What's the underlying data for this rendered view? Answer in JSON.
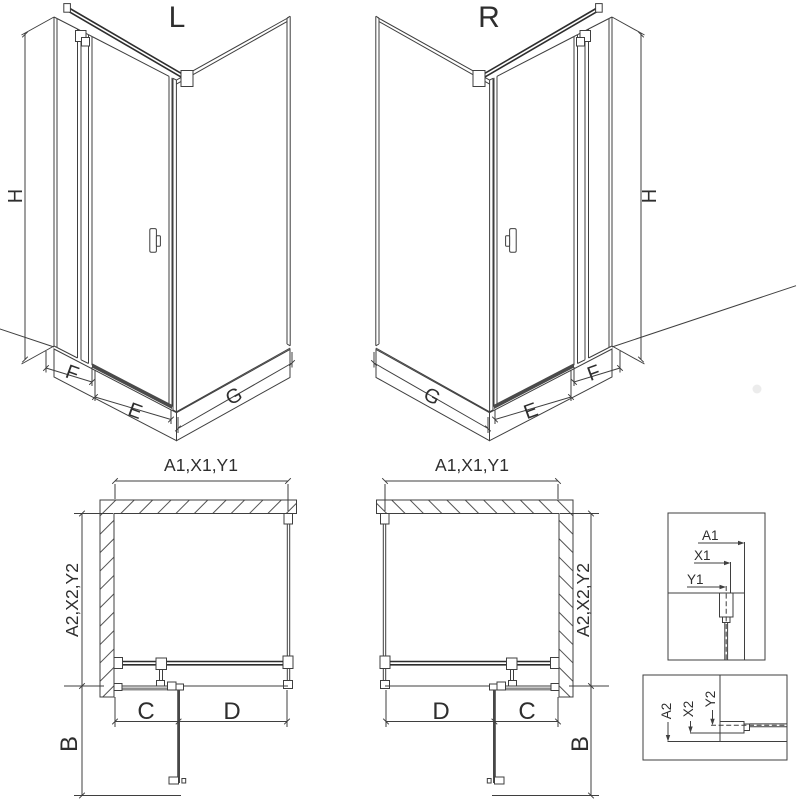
{
  "diagram": {
    "variant_left": {
      "title": "L",
      "dim_height": "H",
      "dim_fixed_panel": "F",
      "dim_door": "E",
      "dim_side_panel": "G"
    },
    "variant_right": {
      "title": "R",
      "dim_height": "H",
      "dim_fixed_panel": "F",
      "dim_door": "E",
      "dim_side_panel": "G"
    },
    "plan_left": {
      "dim_width": "A1,X1,Y1",
      "dim_depth": "A2,X2,Y2",
      "dim_fixed": "C",
      "dim_door": "D",
      "dim_swing": "B"
    },
    "plan_right": {
      "dim_width": "A1,X1,Y1",
      "dim_depth": "A2,X2,Y2",
      "dim_fixed": "C",
      "dim_door": "D",
      "dim_swing": "B"
    },
    "detail_wall_vertical": {
      "dim_outer": "A1",
      "dim_mid": "X1",
      "dim_axis": "Y1"
    },
    "detail_wall_horizontal": {
      "dim_outer": "A2",
      "dim_mid": "X2",
      "dim_axis": "Y2"
    },
    "colors": {
      "line": "#3f3f3f",
      "door_dark": "#474747",
      "fixed_glass": "#8f8f8f",
      "background": "#ffffff"
    }
  }
}
